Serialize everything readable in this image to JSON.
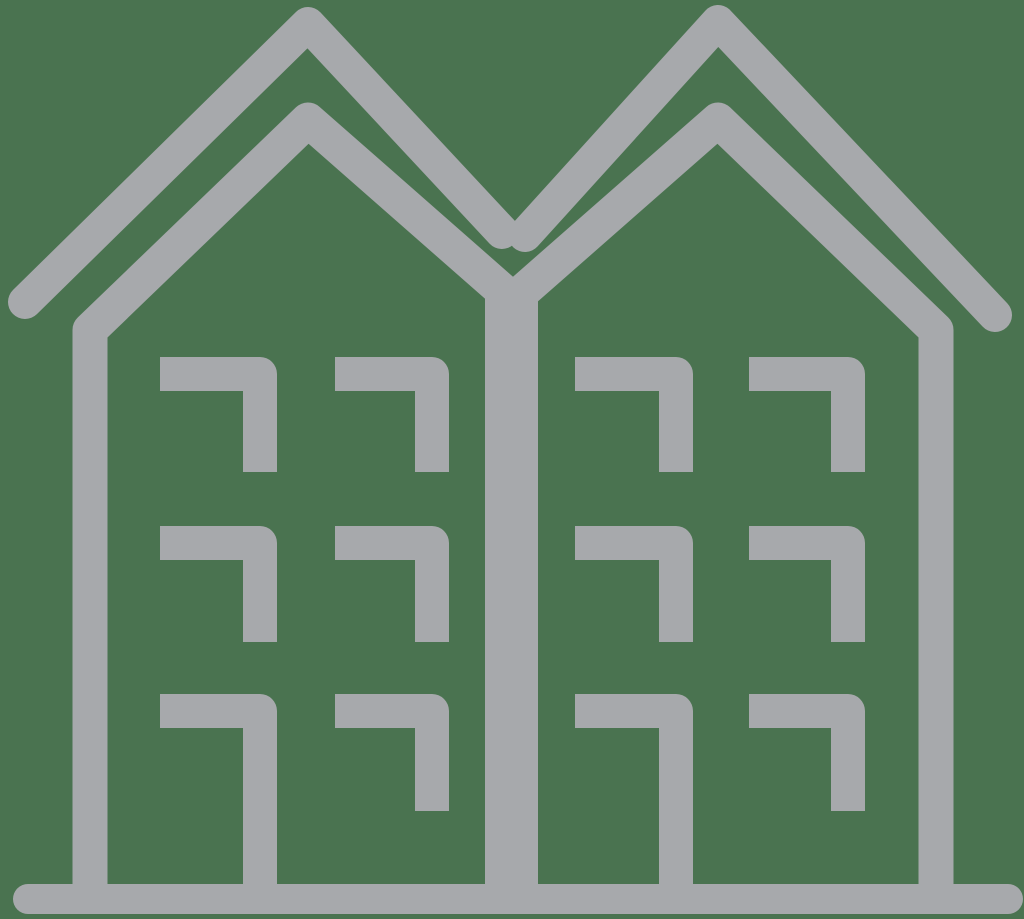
{
  "canvas": {
    "width": 1024,
    "height": 919,
    "background_color": "#4A7350"
  },
  "icon": {
    "name": "townhouses-icon",
    "description": "line-art icon of two attached gable-roof buildings with window corner marks and a ground line",
    "stroke_color": "#A7A9AC",
    "parts": [
      {
        "name": "outer-roof-left",
        "d": "M 25 302 L 308 24 L 502 232",
        "width": 34,
        "cap": "round"
      },
      {
        "name": "outer-roof-right",
        "d": "M 525 235 L 718 22 L 995 315",
        "width": 34,
        "cap": "round"
      },
      {
        "name": "left-building-outline",
        "d": "M 90 903 L 90 330 L 308 120 L 513 300",
        "width": 35,
        "cap": "butt"
      },
      {
        "name": "right-building-outline",
        "d": "M 513 300 L 718 120 L 936 330 L 936 903",
        "width": 35,
        "cap": "butt"
      },
      {
        "name": "party-wall",
        "d": "M 511.5 290 L 511.5 903",
        "width": 53,
        "cap": "butt"
      },
      {
        "name": "ground-line",
        "d": "M 28 899 L 1008 899",
        "width": 30,
        "cap": "round"
      },
      {
        "name": "window-left-col1-row1",
        "d": "M 160 374 L 260 374 L 260 472",
        "width": 34,
        "cap": "butt"
      },
      {
        "name": "window-left-col2-row1",
        "d": "M 335 374 L 432 374 L 432 472",
        "width": 34,
        "cap": "butt"
      },
      {
        "name": "window-right-col1-row1",
        "d": "M 575 374 L 676 374 L 676 472",
        "width": 34,
        "cap": "butt"
      },
      {
        "name": "window-right-col2-row1",
        "d": "M 749 374 L 848 374 L 848 472",
        "width": 34,
        "cap": "butt"
      },
      {
        "name": "window-left-col1-row2",
        "d": "M 160 543 L 260 543 L 260 642",
        "width": 34,
        "cap": "butt"
      },
      {
        "name": "window-left-col2-row2",
        "d": "M 335 543 L 432 543 L 432 642",
        "width": 34,
        "cap": "butt"
      },
      {
        "name": "window-right-col1-row2",
        "d": "M 575 543 L 676 543 L 676 642",
        "width": 34,
        "cap": "butt"
      },
      {
        "name": "window-right-col2-row2",
        "d": "M 749 543 L 848 543 L 848 642",
        "width": 34,
        "cap": "butt"
      },
      {
        "name": "window-left-col1-row3",
        "d": "M 160 711 L 260 711 L 260 905",
        "width": 34,
        "cap": "butt"
      },
      {
        "name": "window-left-col2-row3",
        "d": "M 335 711 L 432 711 L 432 811",
        "width": 34,
        "cap": "butt"
      },
      {
        "name": "window-right-col1-row3",
        "d": "M 575 711 L 676 711 L 676 905",
        "width": 34,
        "cap": "butt"
      },
      {
        "name": "window-right-col2-row3",
        "d": "M 749 711 L 848 711 L 848 811",
        "width": 34,
        "cap": "butt"
      }
    ]
  }
}
